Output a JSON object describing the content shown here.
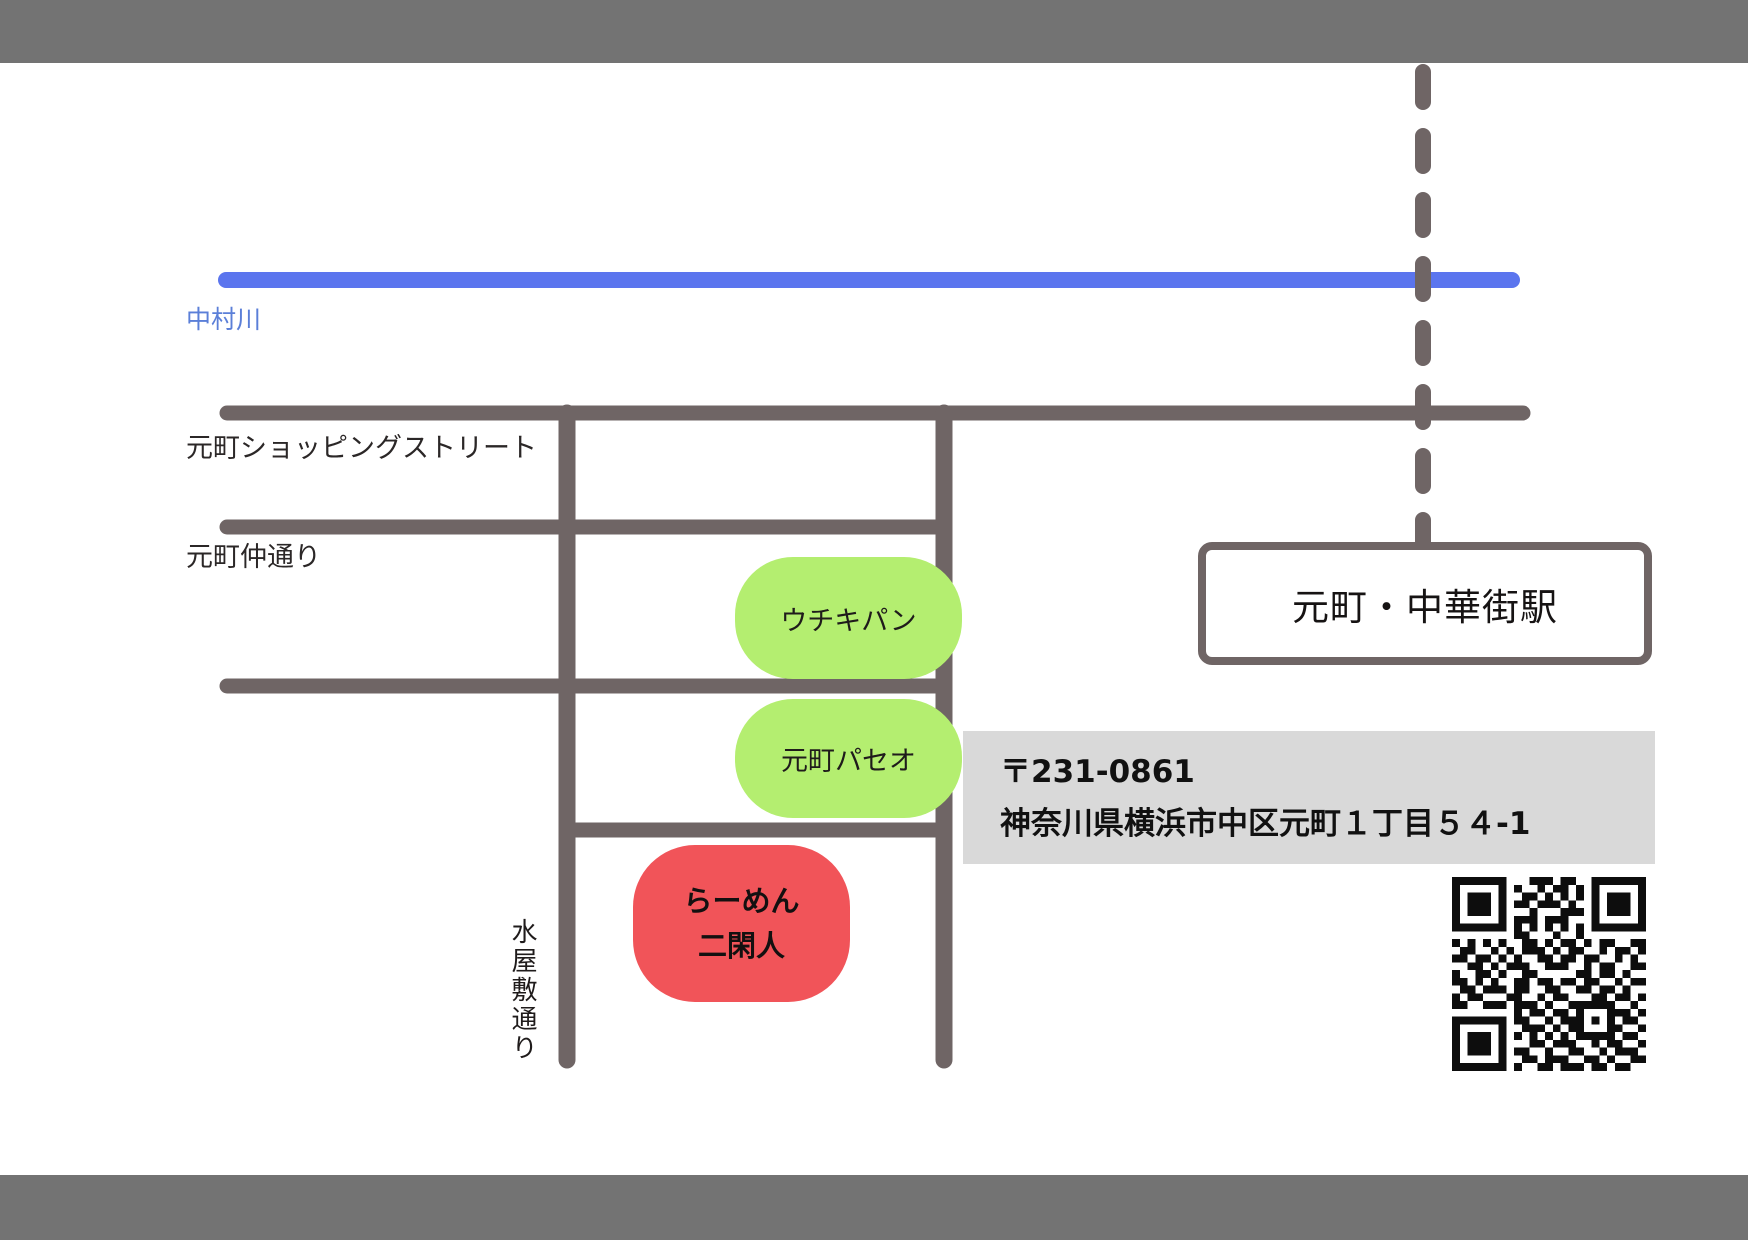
{
  "colors": {
    "frame_bar": "#737373",
    "road": "#6f6565",
    "river": "#5b75ee",
    "river_label": "#5b7fd8",
    "landmark_green": "#b4ee70",
    "destination_red": "#f15459",
    "address_bg": "#d9d9d9",
    "qr_dark": "#0d0d0d"
  },
  "river": {
    "label": "中村川"
  },
  "roads": {
    "shopping_street_label": "元町ショッピングストリート",
    "nakadori_label": "元町仲通り",
    "mizuyashiki_label": "水屋敷通り"
  },
  "station": {
    "label": "元町・中華街駅"
  },
  "pois": {
    "uchiki": {
      "label": "ウチキパン"
    },
    "paseo": {
      "label": "元町パセオ"
    },
    "ramen": {
      "line1": "らーめん",
      "line2": "二閑人"
    }
  },
  "address": {
    "postal": "〒231-0861",
    "street": "神奈川県横浜市中区元町１丁目５４-1"
  },
  "qr": {
    "modules": 25,
    "color": "#0d0d0d",
    "rows": [
      "1111111000111011001111111",
      "1000001010010110101000001",
      "1011101001101010101011101",
      "1011101011011101001011101",
      "1011101000100011101011101",
      "1000001011101110001000001",
      "1111111010101010101111111",
      "0000000011000100100000000",
      "1010101001101011010110011",
      "0110010101110101100101101",
      "1101101010011011011001010",
      "0011010111001110010110011",
      "1001101001100000110110100",
      "1101010011011011011001011",
      "0110111011001100110110100",
      "1011000110010110001101101",
      "1100111011101001111110010",
      "0000000010110110100011101",
      "1111111011001011101010110",
      "1000001001110101100011001",
      "1011101010101010111110110",
      "1011101000110111001011001",
      "1011101011001001100101110",
      "1000001001101110011010011",
      "1111111010011011101101100"
    ]
  }
}
